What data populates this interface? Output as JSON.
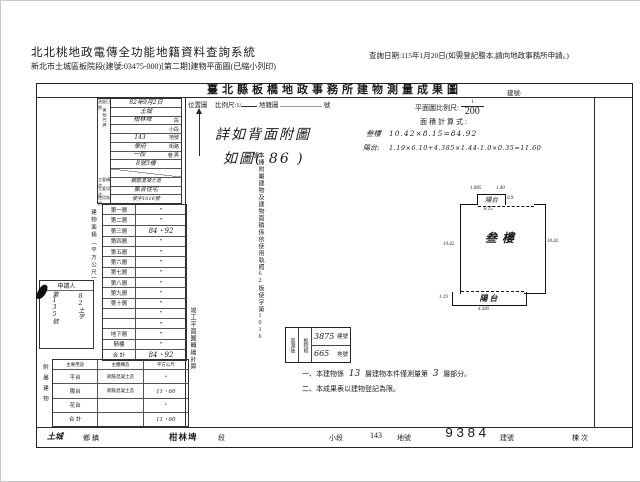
{
  "header": {
    "system_title": "北北桃地政電傳全功能地籍資料查詢系統",
    "query_date": "查詢日期:115年1月20日(如需登記謄本,請向地政事務所申請。)",
    "subtitle": "新北市土城區板院段(建號:03475-000)[第二期]建物平面圖(已縮小列印)"
  },
  "sheet": {
    "title": "臺北縣板橋地政事務所建物測量成果圖",
    "building_no_label": "建號:",
    "location": {
      "label": "位置圖",
      "scale_prefix": "比例尺:1/",
      "cadastral": "地籍圖",
      "sheet_no": "號",
      "hw_line1": "詳如背面附圖",
      "hw_line2": "如圖( 86 )"
    },
    "plan_scale": {
      "label": "平面圖比例尺:",
      "num": "1",
      "den": "200"
    },
    "calc": {
      "label": "面積計算式:",
      "row1_name": "叁樓",
      "row1_formula": "10.42×8.15=84.92",
      "row2_name": "陽台:",
      "row2_formula": "1.19×6.10+4.385×1.44-1.0×0.35=11.60"
    },
    "info": {
      "labels": {
        "r1": "測量日期",
        "r2_8": "建物門牌",
        "r10": "主要構造",
        "r11": "主要用途",
        "r12": "使用執照"
      },
      "rows": [
        {
          "value": "82年9月2日",
          "suffix": ""
        },
        {
          "value": "土城",
          "suffix": ""
        },
        {
          "value": "柑林埤",
          "suffix": "段"
        },
        {
          "value": "",
          "suffix": "小段"
        },
        {
          "value": "143",
          "suffix": "地號"
        },
        {
          "value": "學府",
          "suffix": "街路"
        },
        {
          "value": "一段",
          "suffix": "巷 弄"
        },
        {
          "value": "8號3樓",
          "suffix": ""
        },
        {
          "value": "",
          "suffix": ""
        },
        {
          "value": "鋼筋混凝土造",
          "suffix": ""
        },
        {
          "value": "集合住宅",
          "suffix": ""
        },
        {
          "value": "使字1016號",
          "suffix": ""
        }
      ]
    },
    "floors": {
      "col_label": "建物面積（平方公尺）",
      "rows": [
        {
          "name": "第一層",
          "value": "•"
        },
        {
          "name": "第二層",
          "value": "•"
        },
        {
          "name": "第三層",
          "value": "84・92"
        },
        {
          "name": "第四層",
          "value": "•"
        },
        {
          "name": "第五層",
          "value": "•"
        },
        {
          "name": "第六層",
          "value": "•"
        },
        {
          "name": "第七層",
          "value": "•"
        },
        {
          "name": "第八層",
          "value": "•"
        },
        {
          "name": "第九層",
          "value": "•"
        },
        {
          "name": "第十層",
          "value": "•"
        },
        {
          "name": "",
          "value": "•"
        },
        {
          "name": "",
          "value": "•"
        },
        {
          "name": "地下層",
          "value": "•"
        },
        {
          "name": "騎樓",
          "value": "•"
        }
      ],
      "total_label": "合 計",
      "total_value": "84・92"
    },
    "annex": {
      "label": "附屬建物",
      "headers": [
        "主要用途",
        "主體構造",
        "平方公尺"
      ],
      "rows": [
        {
          "use": "平台",
          "structure": "鋼筋混凝土造",
          "area": "•"
        },
        {
          "use": "陽台",
          "structure": "鋼筋混凝土造",
          "area": "11・60"
        },
        {
          "use": "花台",
          "structure": "",
          "area": "•"
        },
        {
          "use": "合 計",
          "structure": "",
          "area": "11・60"
        }
      ]
    },
    "applicant": {
      "label": "申請人",
      "hw1": "82土字",
      "hw2": "第135號"
    },
    "vnotes": {
      "a": "本棟附屬建物及建物面積係依使用執照62板使字第1016號",
      "b": "竣工平面圖轉繪計算"
    },
    "stamp": {
      "c1": "查測後",
      "c2": "板院段",
      "v1": "3875",
      "l1": "建號",
      "v2": "665",
      "l2": "地號"
    },
    "notes": {
      "n1a": "一、本建物係",
      "n1b": "13",
      "n1c": "層建物本件僅測量第",
      "n1d": "3",
      "n1e": "層部分。",
      "n2": "二、本成果表以建物登記為限。"
    },
    "plan": {
      "main_label": "叁樓",
      "notch_label": "陽台",
      "balcony_label": "陽台",
      "dims": {
        "top1": "1.085",
        "top2": "1.40",
        "notch_right": "0.9",
        "top_width": "8.15",
        "left": "10.42",
        "right": "10.42",
        "balcony_left": "1.19",
        "balcony_bottom": "4.385"
      }
    },
    "bottom": {
      "township_value": "土城",
      "township_label": "鄉鎮",
      "section_value": "柑林埤",
      "section_label": "段",
      "subsection_label": "小段",
      "lot_value": "143",
      "lot_label": "地號",
      "bno_value": "9384",
      "bno_label": "建號",
      "dong_label": "棟次"
    }
  }
}
